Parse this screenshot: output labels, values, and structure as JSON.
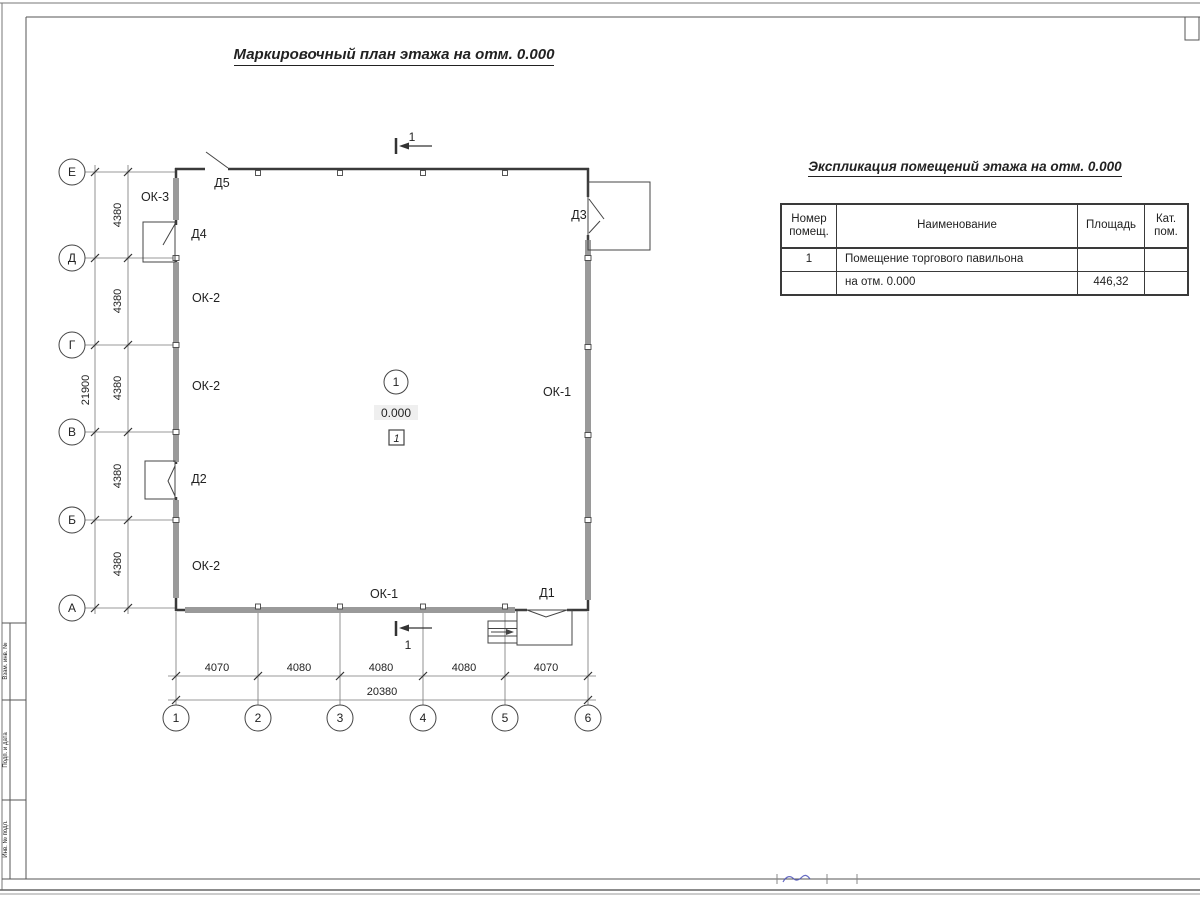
{
  "header": {
    "title": "Маркировочный план этажа на отм. 0.000"
  },
  "plan": {
    "axis_letters": [
      "Е",
      "Д",
      "Г",
      "В",
      "Б",
      "А"
    ],
    "axis_numbers": [
      "1",
      "2",
      "3",
      "4",
      "5",
      "6"
    ],
    "dim_v_total": "21900",
    "dim_v_segs": [
      "4380",
      "4380",
      "4380",
      "4380",
      "4380"
    ],
    "dim_h_segs": [
      "4070",
      "4080",
      "4080",
      "4080",
      "4070"
    ],
    "dim_h_total": "20380",
    "labels": {
      "ok1": "ОК-1",
      "ok2": "ОК-2",
      "ok3": "ОК-3",
      "d1": "Д1",
      "d2": "Д2",
      "d3": "Д3",
      "d4": "Д4",
      "d5": "Д5"
    },
    "room": {
      "number": "1",
      "elevation": "0.000",
      "zone": "1"
    },
    "section_mark": "1"
  },
  "table": {
    "title": "Экспликация помещений этажа на отм. 0.000",
    "headers": [
      "Номер помещ.",
      "Наименование",
      "Площадь",
      "Кат. пом."
    ],
    "rows": [
      [
        "1",
        "Помещение торгового павильона",
        "",
        ""
      ],
      [
        "",
        "на отм. 0.000",
        "446,32",
        ""
      ]
    ]
  },
  "stamp": {
    "labels": [
      "Взам. инв. №",
      "Подп. и дата",
      "Инв. № подл."
    ]
  },
  "colors": {
    "line": "#3a3a3a",
    "window_band": "#9a9a9a",
    "signature_blue": "#4c52b8"
  }
}
